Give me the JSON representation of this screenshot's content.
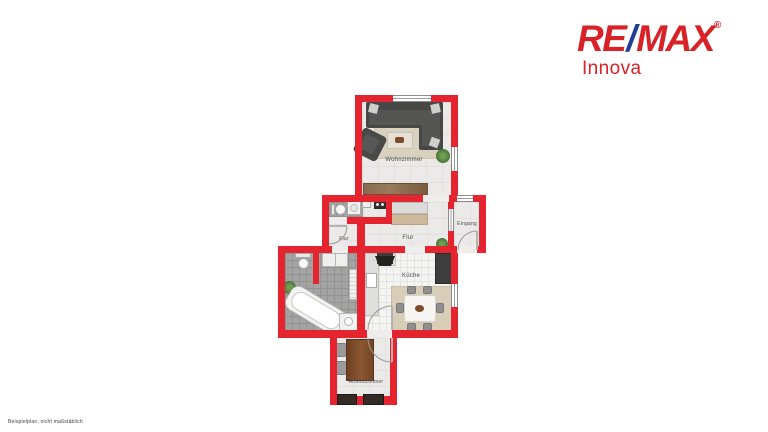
{
  "logo": {
    "part1": "RE",
    "slash": "/",
    "part2": "MAX",
    "registered": "®",
    "subtitle": "Innova",
    "colors": {
      "red": "#d92128",
      "blue": "#1f3d99"
    }
  },
  "floorplan": {
    "wall_color": "#e4242e",
    "floor_light": "#ebeae8",
    "floor_tile_gray": "#a3a3a3",
    "floor_tile_white": "#f4f4f2",
    "rooms": [
      {
        "id": "wohnzimmer",
        "label": "Wohnzimmer"
      },
      {
        "id": "flur-klein",
        "label": "Flur"
      },
      {
        "id": "flur",
        "label": "Flur"
      },
      {
        "id": "eingang",
        "label": "Eingang"
      },
      {
        "id": "kueche",
        "label": "Küche"
      },
      {
        "id": "arbeitszimmer",
        "label": "Arbeitszimmer"
      }
    ]
  },
  "footer": {
    "disclaimer": "Beispielplan, nicht maßstäblich"
  }
}
